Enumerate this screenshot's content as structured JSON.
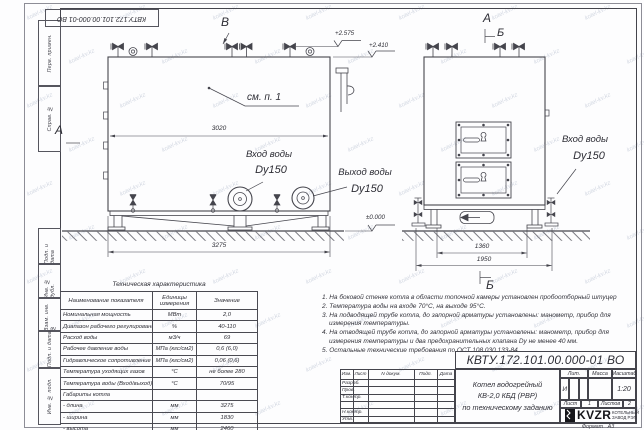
{
  "sheet": {
    "stamp_number": "КВТУ.172.101.00.000-01 ВО",
    "format_label": "Формат",
    "format_value": "А3"
  },
  "margin_labels": [
    "Перв. примен.",
    "Справ. №",
    "Подп. и дата",
    "Инв. № дубл.",
    "Взам. инв. №",
    "Подп. и дата",
    "Инв. № подл."
  ],
  "views": {
    "front": {
      "marker_top": "В",
      "marker_left": "А",
      "callout": "см. п. 1",
      "dim_width": "3020",
      "dim_length": "3275",
      "inlet_label": "Вход воды",
      "inlet_size": "Dy150",
      "outlet_label": "Выход воды",
      "outlet_size": "Dy150",
      "elev_top": "+2.575",
      "elev_mid": "+2.410",
      "elev_zero": "±0.000"
    },
    "side": {
      "marker_a": "А",
      "marker_b": "Б",
      "marker_b_bottom": "Б",
      "dim_inner": "1360",
      "dim_outer": "1950",
      "inlet_label": "Вход воды",
      "inlet_size": "Dy150"
    }
  },
  "tech_table": {
    "title": "Техническая характеристика",
    "headers": [
      "Наименование показателя",
      "Единицы измерения",
      "Значение"
    ],
    "rows": [
      [
        "Номинальная мощность",
        "МВт",
        "2,0"
      ],
      [
        "Диапазон рабочего регулирования",
        "%",
        "40-110"
      ],
      [
        "Расход воды",
        "м3/ч",
        "69"
      ],
      [
        "Рабочее давление воды",
        "МПа (кгс/см2)",
        "0,6 (6,0)"
      ],
      [
        "Гидравлическое сопротивление котла",
        "МПа (кгс/см2)",
        "0,06 (0,6)"
      ],
      [
        "Температура уходящих газов",
        "°С",
        "не более 280"
      ],
      [
        "Температура воды (Вход/выход)",
        "°С",
        "70/95"
      ],
      [
        "Габариты котла",
        "",
        ""
      ],
      [
        "- длина",
        "мм",
        "3275"
      ],
      [
        "- ширина",
        "мм",
        "1830"
      ],
      [
        "- высота",
        "мм",
        "2460"
      ]
    ]
  },
  "notes": [
    "1.  На боковой стенке котла в области топочной камеры установлен пробоотборный штуцер",
    "2.  Температура воды на входе  70°С, на выходе  95°С.",
    "3.  На подводящей трубе котла, до запорной арматуры установлены: манометр, прибор для измерения температуры.",
    "4.  На отводящей трубе котла, до запорной арматуры установлены: манометр, прибор для измерения температуры и два предохранительных клапана  Dу не менее  40 мм.",
    "5.  Остальные технические требования по ОСТ  108.030.133-84."
  ],
  "title_block": {
    "doc_number": "КВТУ.172.101.00.000-01 ВО",
    "title_lines": [
      "Котел водогрейный",
      "КВ-2,0 КБД  (РВР)",
      "по техническому заданию"
    ],
    "header_cols": [
      "Изм.",
      "Лист",
      "N докум.",
      "Подп.",
      "Дата"
    ],
    "row_labels": [
      "Разраб.",
      "Пров.",
      "Т.контр.",
      "",
      "Н.контр.",
      "Утв."
    ],
    "lit_header": "Лит.",
    "mass_header": "Масса",
    "scale_header": "Масштаб",
    "lit_value": "И",
    "scale_value": "1:20",
    "sheet_label": "Лист",
    "sheet_value": "1",
    "sheets_label": "Листов",
    "sheets_value": "2",
    "logo_text": "KVZR",
    "logo_caption_1": "КОТЕЛЬНЫЙ",
    "logo_caption_2": "ЗАВОД РЭП"
  },
  "watermark": {
    "text": "kotel-kv.kz"
  },
  "colors": {
    "line": "#45454d",
    "paper": "#fdfdfe",
    "watermark": "#8290aa"
  }
}
